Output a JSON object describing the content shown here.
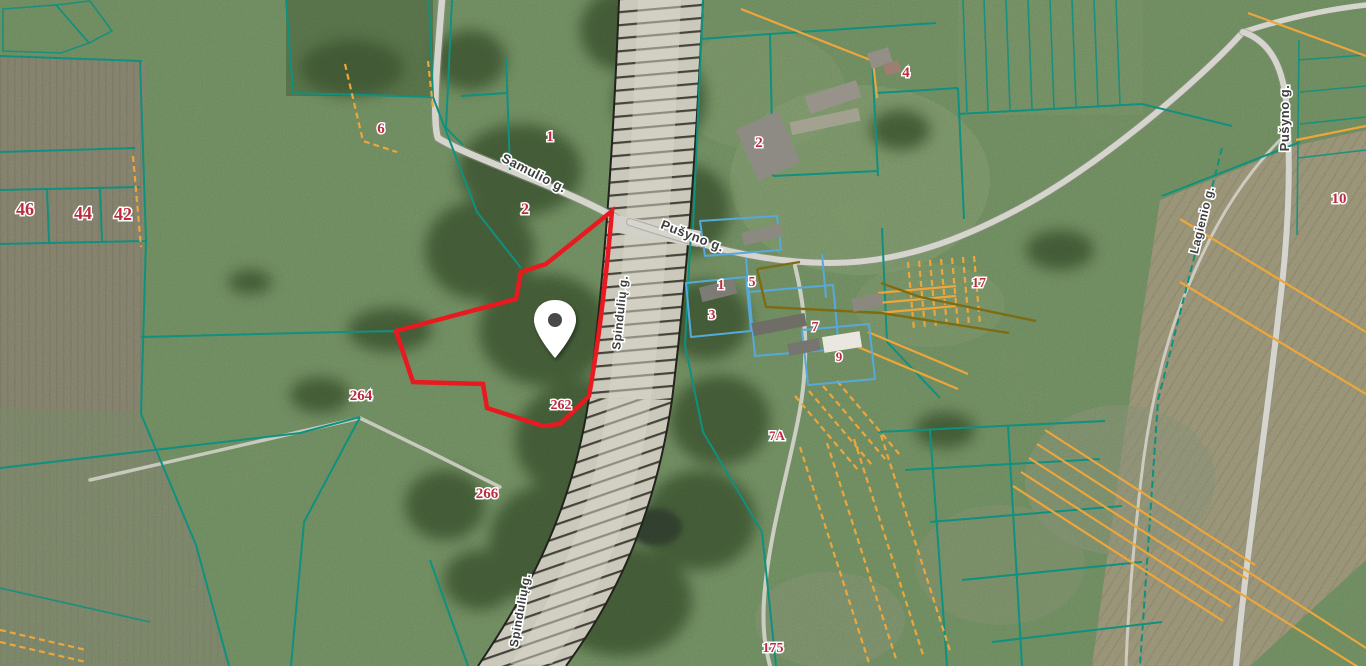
{
  "map": {
    "type": "cadastral-satellite-map",
    "colors": {
      "parcel_teal": "#10907f",
      "parcel_orange": "#eda63b",
      "parcel_blue": "#56a9da",
      "parcel_olive": "#7d6c14",
      "highlight_red": "#e8191f",
      "parcel_number_text": "#bb2c40",
      "street_text": "#3d3e3e",
      "marker_fill": "#ffffff"
    },
    "marker": {
      "x": 555,
      "y": 330,
      "name": "selected-property-pin"
    },
    "street_labels": [
      {
        "text": "Samulio g.",
        "x": 532,
        "y": 177,
        "rot": 27,
        "size": 13
      },
      {
        "text": "Pušyno g.",
        "x": 691,
        "y": 240,
        "rot": 21,
        "size": 13
      },
      {
        "text": "Pušyno g.",
        "x": 1289,
        "y": 118,
        "rot": -90,
        "size": 13
      },
      {
        "text": "Lagienio g.",
        "x": 1206,
        "y": 221,
        "rot": -76,
        "size": 12
      },
      {
        "text": "Spindulių g.",
        "x": 624,
        "y": 313,
        "rot": -84,
        "size": 12
      },
      {
        "text": "Spindulių g.",
        "x": 524,
        "y": 611,
        "rot": -80,
        "size": 12
      }
    ],
    "parcel_labels": [
      {
        "text": "46",
        "x": 25,
        "y": 215,
        "size": 18
      },
      {
        "text": "44",
        "x": 83,
        "y": 219,
        "size": 18
      },
      {
        "text": "42",
        "x": 123,
        "y": 220,
        "size": 18
      },
      {
        "text": "6",
        "x": 381,
        "y": 133,
        "size": 15
      },
      {
        "text": "1",
        "x": 550,
        "y": 141,
        "size": 15
      },
      {
        "text": "2",
        "x": 525,
        "y": 214,
        "size": 16
      },
      {
        "text": "2",
        "x": 759,
        "y": 147,
        "size": 15
      },
      {
        "text": "4",
        "x": 906,
        "y": 77,
        "size": 15
      },
      {
        "text": "1",
        "x": 721,
        "y": 289,
        "size": 14
      },
      {
        "text": "5",
        "x": 752,
        "y": 286,
        "size": 14
      },
      {
        "text": "3",
        "x": 712,
        "y": 319,
        "size": 14
      },
      {
        "text": "7",
        "x": 815,
        "y": 331,
        "size": 14
      },
      {
        "text": "9",
        "x": 839,
        "y": 361,
        "size": 13
      },
      {
        "text": "17",
        "x": 979,
        "y": 287,
        "size": 14
      },
      {
        "text": "7A",
        "x": 777,
        "y": 440,
        "size": 13
      },
      {
        "text": "264",
        "x": 361,
        "y": 400,
        "size": 15
      },
      {
        "text": "262",
        "x": 561,
        "y": 409,
        "size": 14
      },
      {
        "text": "266",
        "x": 487,
        "y": 498,
        "size": 15
      },
      {
        "text": "10",
        "x": 1339,
        "y": 203,
        "size": 15
      },
      {
        "text": "175",
        "x": 773,
        "y": 652,
        "size": 14
      }
    ]
  }
}
